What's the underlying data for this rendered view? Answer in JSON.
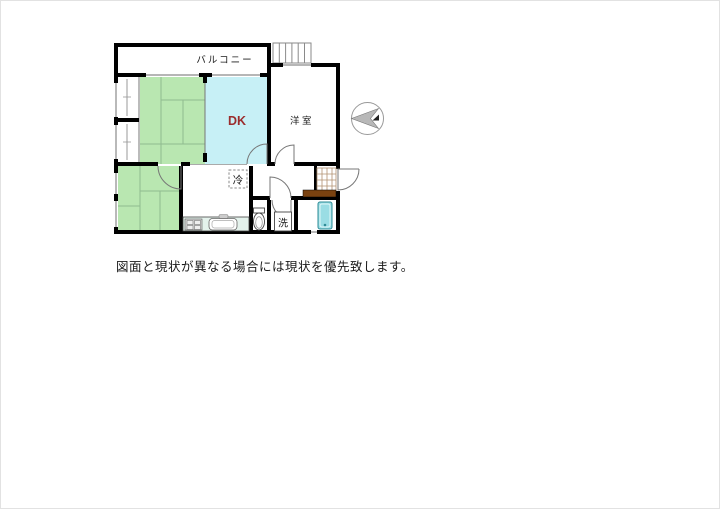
{
  "labels": {
    "balcony": "バルコニー",
    "dk": "DK",
    "western_room": "洋室",
    "fridge": "冷",
    "washer": "洗"
  },
  "disclaimer": "図面と現状が異なる場合には現状を優先致します。",
  "icons": {
    "compass": "north-arrow",
    "stairs": "stairs",
    "toilet": "toilet",
    "bathtub": "bathtub",
    "stove": "stove",
    "sink": "kitchen-sink"
  },
  "colors": {
    "wall": "#000000",
    "tatami": "#b9e7b1",
    "dk_room": "#c7f0f6",
    "dk_text": "#9b2d2d",
    "tub": "#9adde4",
    "tub_edge": "#2e8b96",
    "counter": "#e4f2ec",
    "step": "#7a4210",
    "tile_line": "#b09070",
    "compass_needle": "#b8b8b8"
  }
}
